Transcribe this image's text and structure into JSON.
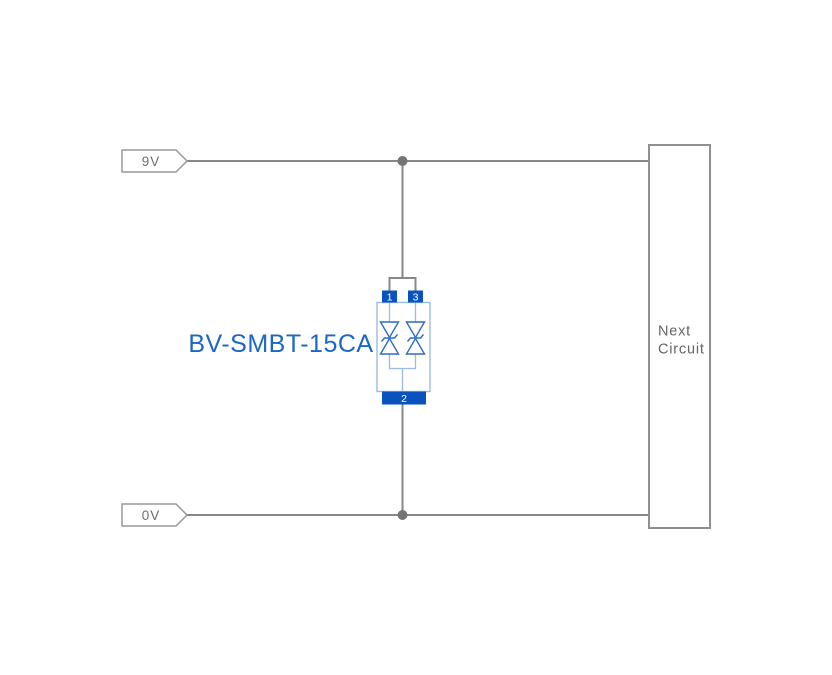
{
  "diagram": {
    "net_labels": {
      "top": "9V",
      "bottom": "0V"
    },
    "component": {
      "label": "BV-SMBT-15CA",
      "pins": {
        "top_left": "1",
        "top_right": "3",
        "bottom": "2"
      }
    },
    "next_circuit_box": {
      "line1": "Next",
      "line2": "Circuit"
    },
    "colors": {
      "wire": "#85878a",
      "junction_dot": "#737577",
      "tag_border": "#97999b",
      "tag_text": "#6b6d70",
      "box_border": "#8e9092",
      "box_text": "#636568",
      "pin_fill": "#0a52bd",
      "pin_text": "#ffffff",
      "component_body_outline": "#9cbbe3",
      "diode_stroke": "#2f6ac6",
      "component_label_text": "#1a66c9",
      "background": "#ffffff"
    }
  }
}
